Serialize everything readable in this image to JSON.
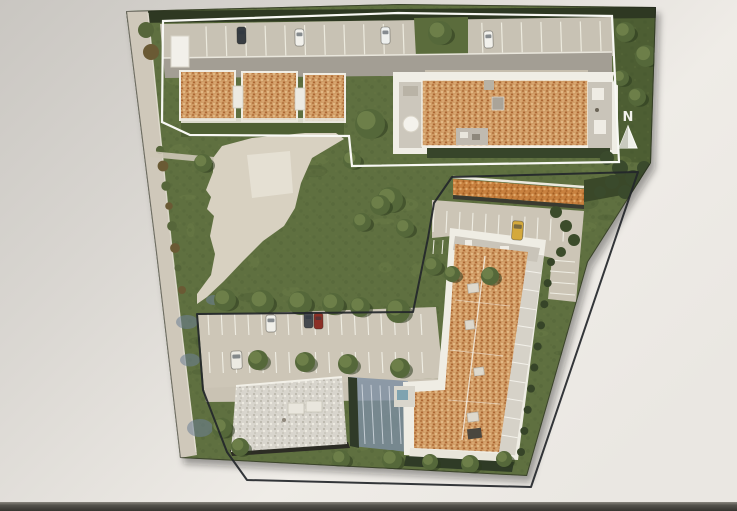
{
  "meta": {
    "title": "Aerial site plan photo on screen"
  },
  "map": {
    "north_label": "N",
    "features": {
      "upper_parcel": "three small terracotta-roof houses, one large terracotta-roof apartment building, parking row with cars",
      "lower_parcel": "L-shaped terracotta-roof building, flat gray-roof building, garage strip, two parking rows with cars",
      "landscape": "lawns, round trees, central paved plaza with winding path, perimeter road"
    }
  },
  "palette": {
    "background_light": "#efece7",
    "background_dark": "#c9c6c1",
    "screen_bar_dark": "#44423c",
    "screen_bar_light": "#76746d",
    "grass": "#5f7040",
    "grass_dark": "#46572e",
    "hedge_dark": "#2e3822",
    "road": "#cfc8ba",
    "parking": "#c8c2b4",
    "plaza": "#d8d1c1",
    "roof_terracotta": "#cf9a63",
    "roof_garage": "#c8813f",
    "roof_flat": "#d8d5cd",
    "building_white": "#f0eee6",
    "boundary_upper": "#f8f8f4",
    "boundary_lower": "#23262a",
    "tree_green": "#55683a",
    "car_yellow": "#d4a93c",
    "car_red": "#8c3026",
    "car_dark": "#383d42",
    "car_white": "#f2f1ec",
    "shadow_blue": "#6b7f95"
  }
}
